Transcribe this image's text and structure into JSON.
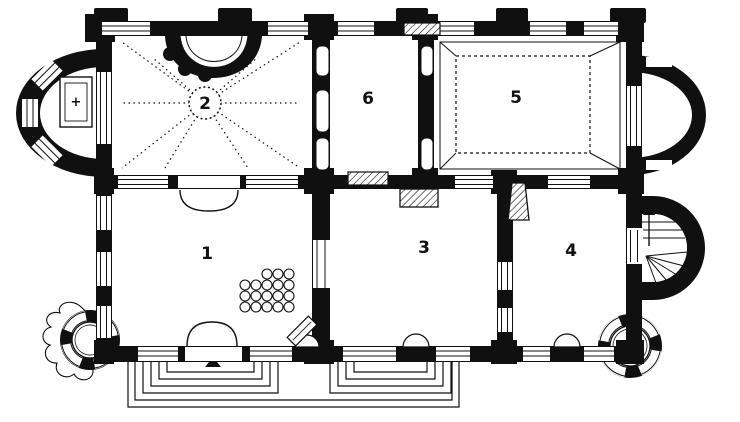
{
  "plan": {
    "title": "castle-ground-floor-plan",
    "rooms": [
      {
        "label": "1"
      },
      {
        "label": "2"
      },
      {
        "label": "3"
      },
      {
        "label": "4"
      },
      {
        "label": "5"
      },
      {
        "label": "6"
      }
    ],
    "symbols": {
      "altar_cross": "+"
    },
    "colors": {
      "ink": "#101010",
      "paper": "#ffffff"
    }
  }
}
